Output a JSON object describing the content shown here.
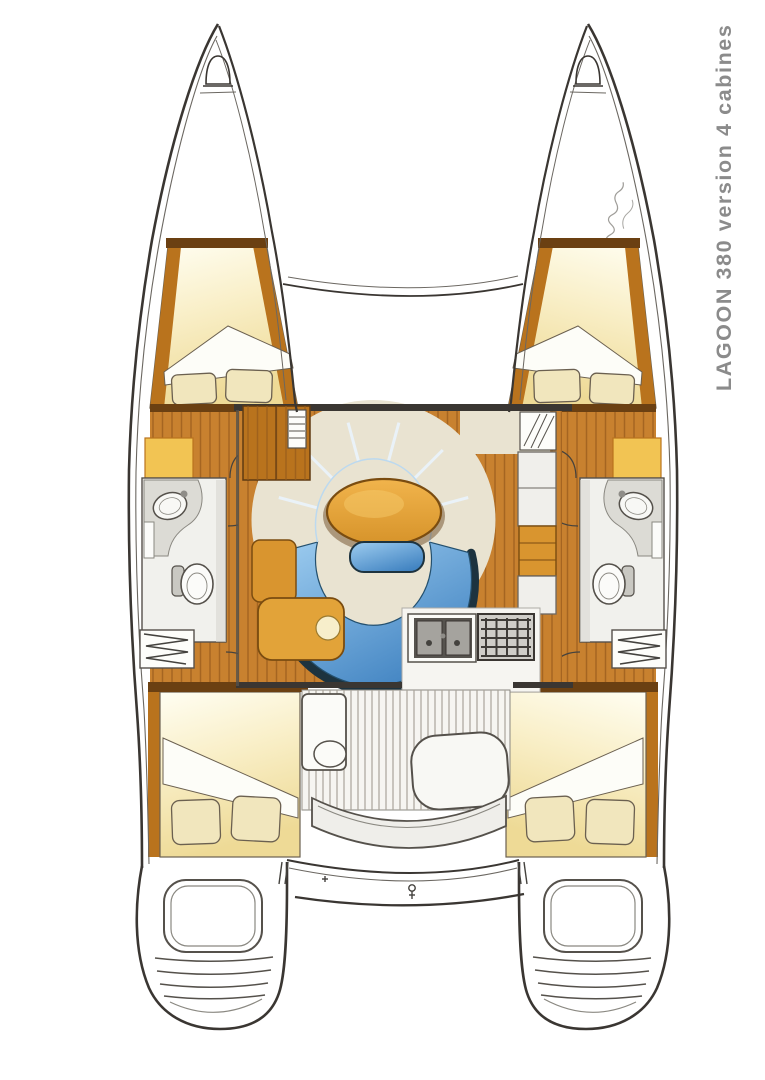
{
  "window": {
    "background": "#ffffff",
    "width": 765,
    "height": 1080
  },
  "title": {
    "text": "LAGOON 380 version 4 cabines",
    "color": "#8b8b8b",
    "orientation": "vertical-bottom-to-top"
  },
  "drawing": {
    "type": "yacht-deck-plan",
    "boat": "Lagoon 380 catamaran",
    "layout": "4 cabins, 2 heads, central salon with curved settee and oval table, galley with sink and stove, nav desk, aft cockpit, twin transom steps",
    "signature": "illegible handwritten artist signature on starboard bow"
  },
  "colors": {
    "line": "#3a3632",
    "line-soft": "#6b6761",
    "wood": "#c8812f",
    "wood-line": "#95591a",
    "wood-trim": "#b9731d",
    "wood-dark": "#6b4012",
    "cabin-light": "#fffef2",
    "cabin-mid": "#f9efc8",
    "cabin-deep": "#eeda96",
    "pillow": "#f1e6bd",
    "cushion-light": "#9ecdf0",
    "cushion-deep": "#4284c2",
    "cushion-rim": "#1d333f",
    "table-light": "#f1b44c",
    "table-deep": "#d6932a",
    "table-edge": "#7a4c10",
    "beige": "#e9e3d1",
    "bath": "#f1f1ed",
    "fixture": "#dcdbd5",
    "steel": "#8f8d88",
    "counter": "#f6f5f1",
    "accent-orange": "#d9952f",
    "accent-yellow": "#f2c453",
    "title": "#8b8b8b"
  },
  "elements": {
    "port-hull": "left hull with forward cabin, head, corridor, aft cabin, transom steps",
    "starboard-hull": "right hull (mirror of port)",
    "salon": "bridgedeck salon: curved blue settee, oval table, footstool",
    "galley": "double sink and stove on aft counter, cabinets to starboard",
    "nav-area": "wardrobe, seat and chart desk to port",
    "cockpit": "slatted floor, table, lounge seat, curved bench",
    "aft-beam": "aft crossbeam with davit fitting",
    "forward-beam": "forward crossbeam between bows"
  }
}
